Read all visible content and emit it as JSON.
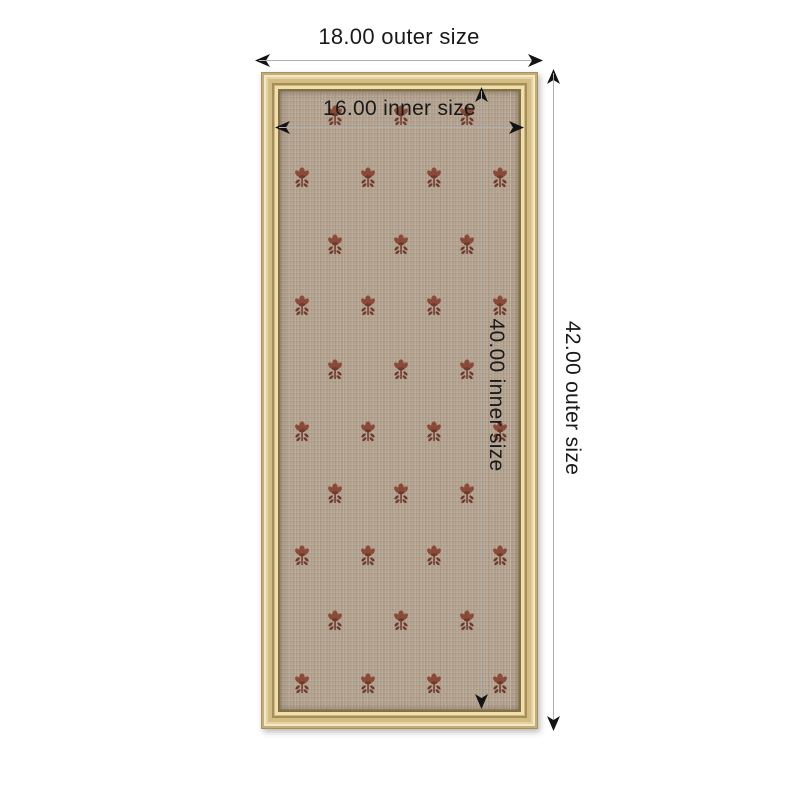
{
  "diagram": {
    "type": "product-dimension-diagram",
    "product": "gold framed fabric pinboard with floral sprig pattern"
  },
  "labels": {
    "outer_width": "18.00 outer size",
    "inner_width": "16.00 inner size",
    "outer_height": "42.00 outer size",
    "inner_height": "40.00 inner size"
  },
  "measurements": {
    "outer_width": 18.0,
    "inner_width": 16.0,
    "outer_height": 42.0,
    "inner_height": 40.0
  },
  "colors": {
    "background": "#ffffff",
    "frame_gold_main": "#d8c28c",
    "frame_gold_highlight": "#f2e8c9",
    "frame_gold_dark": "#a68d55",
    "fabric_beige": "#b5a491",
    "motif_primary": "#8a4a39",
    "motif_secondary": "#6f392b",
    "dimension_line": "#afafaf",
    "arrow_head": "#141414",
    "text": "#1a1a1a"
  },
  "icons": {
    "arrowheads": [
      "arrowhead-left-icon",
      "arrowhead-right-icon",
      "arrowhead-up-icon",
      "arrowhead-down-icon"
    ],
    "motif": "flower-sprig-icon"
  },
  "pattern": {
    "motif_width": 20,
    "motif_height": 24,
    "fabric_origin": {
      "x": 279,
      "y": 90
    },
    "rows": [
      {
        "y": 115,
        "x": [
          334,
          400,
          466
        ]
      },
      {
        "y": 177,
        "x": [
          301,
          367,
          433,
          499
        ]
      },
      {
        "y": 244,
        "x": [
          334,
          400,
          466
        ]
      },
      {
        "y": 305,
        "x": [
          301,
          367,
          433,
          499
        ]
      },
      {
        "y": 369,
        "x": [
          334,
          400,
          466
        ]
      },
      {
        "y": 431,
        "x": [
          301,
          367,
          433,
          499
        ]
      },
      {
        "y": 493,
        "x": [
          334,
          400,
          466
        ]
      },
      {
        "y": 555,
        "x": [
          301,
          367,
          433,
          499
        ]
      },
      {
        "y": 620,
        "x": [
          334,
          400,
          466
        ]
      },
      {
        "y": 683,
        "x": [
          301,
          367,
          433,
          499
        ]
      }
    ]
  }
}
